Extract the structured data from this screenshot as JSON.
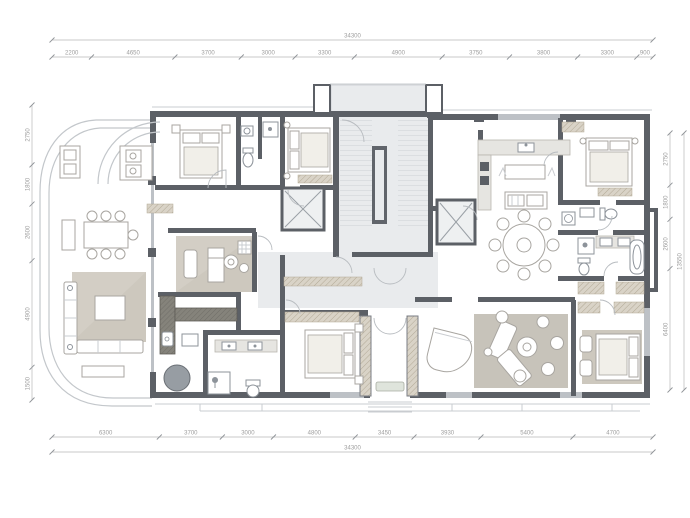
{
  "plan": {
    "title": "residential-floor-plan",
    "colors": {
      "wall": "#5c6066",
      "wallLight": "#bdc1c6",
      "outline": "#c9ccd0",
      "curve": "#c3c7cb",
      "floorCore": "#e9ebed",
      "carpet": "#cdc8be",
      "carpetDark": "#c7c3ba",
      "hatchBase": "#d9d3c7",
      "hatchLine": "#b2a996",
      "counterBase": "#85837b",
      "counterLine": "#6b6963",
      "furnitureFill": "#ffffff",
      "furnitureStroke": "#a8a5a0",
      "fixtureStroke": "#8d939a",
      "tubFill": "#979da3",
      "dimLine": "#b7b7b7",
      "dimText": "#9d9d9d"
    },
    "dimensions": {
      "top": {
        "total": "34300",
        "segments": [
          "2200",
          "4650",
          "3700",
          "3000",
          "3300",
          "4900",
          "3750",
          "3800",
          "3300",
          "900"
        ]
      },
      "bottom": {
        "total": "34300",
        "segments": [
          "6300",
          "3700",
          "3000",
          "4800",
          "3450",
          "3930",
          "5400",
          "4700"
        ]
      },
      "left": {
        "segments": [
          "2750",
          "1800",
          "2600",
          "4900",
          "1500"
        ]
      },
      "right": {
        "total": "13550",
        "segments": [
          "2750",
          "1800",
          "2600",
          "6400"
        ]
      }
    }
  }
}
